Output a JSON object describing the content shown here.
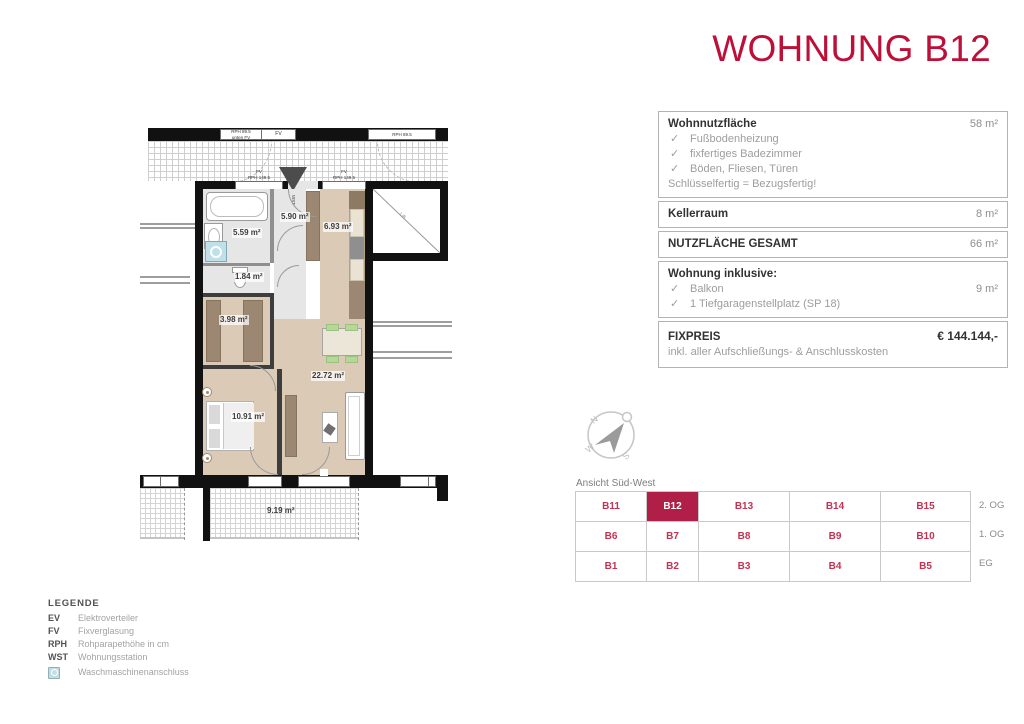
{
  "title": "WOHNUNG B12",
  "colors": {
    "accent_red": "#bd0f38",
    "selected_cell_red": "#b01f47",
    "cell_text_red": "#c23352"
  },
  "info_panel": {
    "check_glyph": "✓",
    "sections": [
      {
        "label": "Wohnnutzfläche",
        "value": "58 m²",
        "items": [
          "Fußbodenheizung",
          "fixfertiges Badezimmer",
          "Böden, Fliesen, Türen"
        ],
        "note": "Schlüsselfertig = Bezugsfertig!"
      },
      {
        "label": "Kellerraum",
        "value": "8 m²"
      },
      {
        "label": "NUTZFLÄCHE GESAMT",
        "value": "66 m²"
      },
      {
        "label": "Wohnung inklusive:",
        "items": [
          {
            "text": "Balkon",
            "value": "9 m²"
          },
          {
            "text": "1 Tiefgaragenstellplatz (SP 18)",
            "value": ""
          }
        ]
      },
      {
        "label": "FIXPREIS",
        "value": "€ 144.144,-",
        "note": "inkl. aller Aufschließungs- & Anschlusskosten"
      }
    ]
  },
  "compass": {
    "letters": {
      "n": "N",
      "w": "W",
      "s": "S"
    }
  },
  "units_table": {
    "caption": "Ansicht Süd-West",
    "selected": "B12",
    "rows": [
      {
        "cells": [
          "B11",
          "B12",
          "B13",
          "B14",
          "B15"
        ],
        "floor": "2. OG"
      },
      {
        "cells": [
          "B6",
          "B7",
          "B8",
          "B9",
          "B10"
        ],
        "floor": "1. OG"
      },
      {
        "cells": [
          "B1",
          "B2",
          "B3",
          "B4",
          "B5"
        ],
        "floor": "EG"
      }
    ]
  },
  "legend": {
    "title": "LEGENDE",
    "entries": [
      {
        "abbr": "EV",
        "desc": "Elektroverteiler"
      },
      {
        "abbr": "FV",
        "desc": "Fixverglasung"
      },
      {
        "abbr": "RPH",
        "desc": "Rohparapethöhe in cm"
      },
      {
        "abbr": "WST",
        "desc": "Wohnungsstation"
      }
    ],
    "icon_entry": {
      "icon": "washing-machine-icon",
      "desc": "Waschmaschinenanschluss"
    }
  },
  "floor_plan": {
    "rooms": [
      {
        "name": "bath",
        "area": "5.59 m²"
      },
      {
        "name": "hall",
        "area": "5.90 m²"
      },
      {
        "name": "kitchen",
        "area": "6.93 m²"
      },
      {
        "name": "wc",
        "area": "1.84 m²"
      },
      {
        "name": "storage",
        "area": "3.98 m²"
      },
      {
        "name": "living",
        "area": "22.72 m²"
      },
      {
        "name": "bedroom",
        "area": "10.91 m²"
      },
      {
        "name": "balcony",
        "area": "9.19 m²"
      }
    ],
    "wall_labels": {
      "top_left_a": "RPH 89.5",
      "top_left_b": "unten FV",
      "top_left_c": "FV",
      "top_right": "RPH 89.5",
      "win_a1": "FV",
      "win_a2": "RPH 149.5",
      "win_b1": "FV",
      "win_b2": "RPH 149.5",
      "bottom": "FV",
      "lift": "Lift",
      "wst": "WST"
    }
  }
}
